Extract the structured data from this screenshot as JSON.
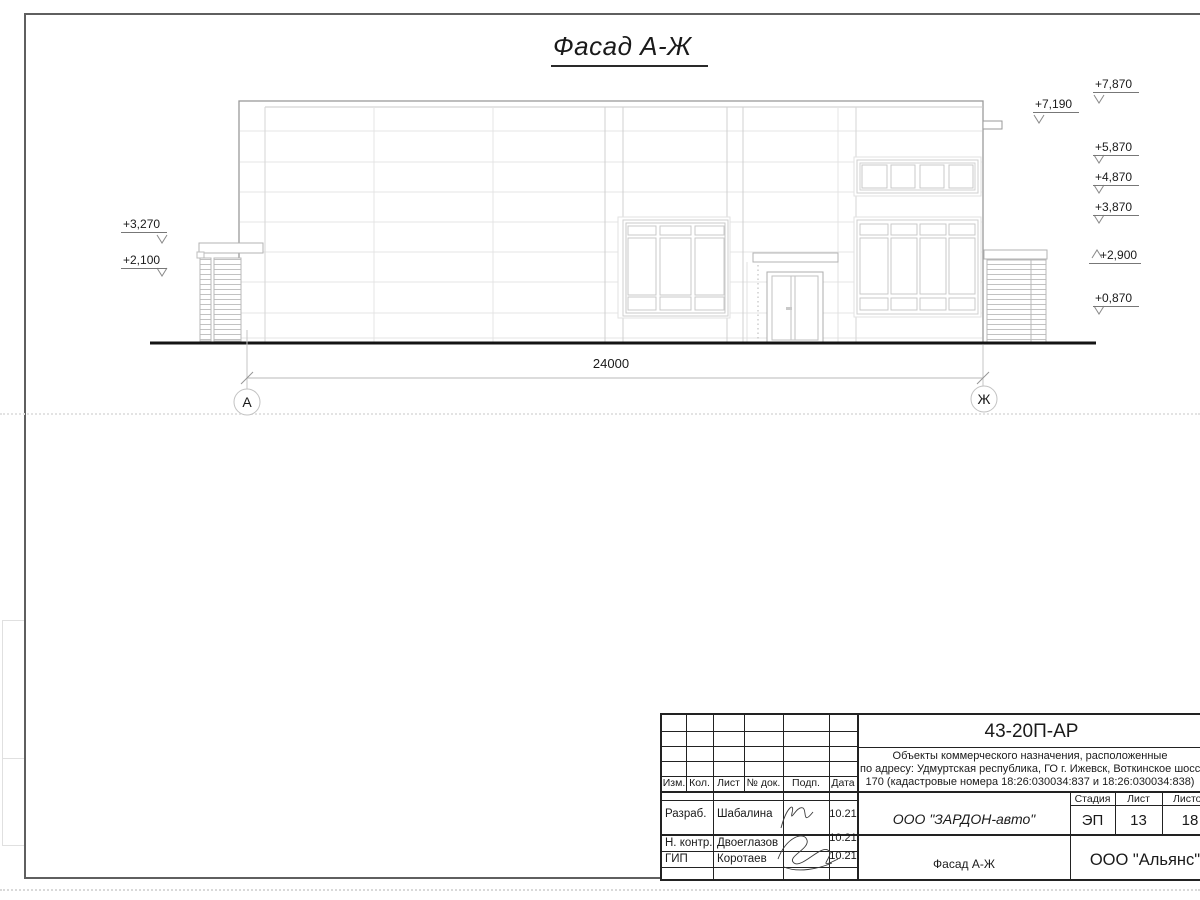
{
  "drawing": {
    "title": "Фасад А-Ж",
    "dimension_total": "24000",
    "axis_left": "А",
    "axis_right": "Ж",
    "elev_right": [
      "+7,870",
      "+7,190",
      "+5,870",
      "+4,870",
      "+3,870",
      "+2,900",
      "+0,870"
    ],
    "elev_left": [
      "+3,270",
      "+2,100"
    ]
  },
  "title_block": {
    "doc_number": "43-20П-АР",
    "description": [
      "Объекты коммерческого назначения, расположенные",
      "по адресу: Удмуртская республика, ГО г. Ижевск, Воткинское шоссе,",
      "170 (кадастровые номера 18:26:030034:837 и 18:26:030034:838)"
    ],
    "rev_headers": [
      "Изм.",
      "Кол.",
      "Лист",
      "№ док.",
      "Подп.",
      "Дата"
    ],
    "roles": [
      {
        "role": "Разраб.",
        "name": "Шабалина",
        "date": "10.21"
      },
      {
        "role": "Н. контр.",
        "name": "Двоеглазов",
        "date": "10.21"
      },
      {
        "role": "ГИП",
        "name": "Коротаев",
        "date": "10.21"
      }
    ],
    "company": "ООО \"ЗАРДОН-авто\"",
    "sheet_name": "Фасад А-Ж",
    "stage_label": "Стадия",
    "sheet_label": "Лист",
    "sheets_label": "Листов",
    "stage": "ЭП",
    "sheet_no": "13",
    "sheets_total": "18",
    "org": "ООО \"Альянс\"",
    "ink_color": "#1a1a1a"
  }
}
